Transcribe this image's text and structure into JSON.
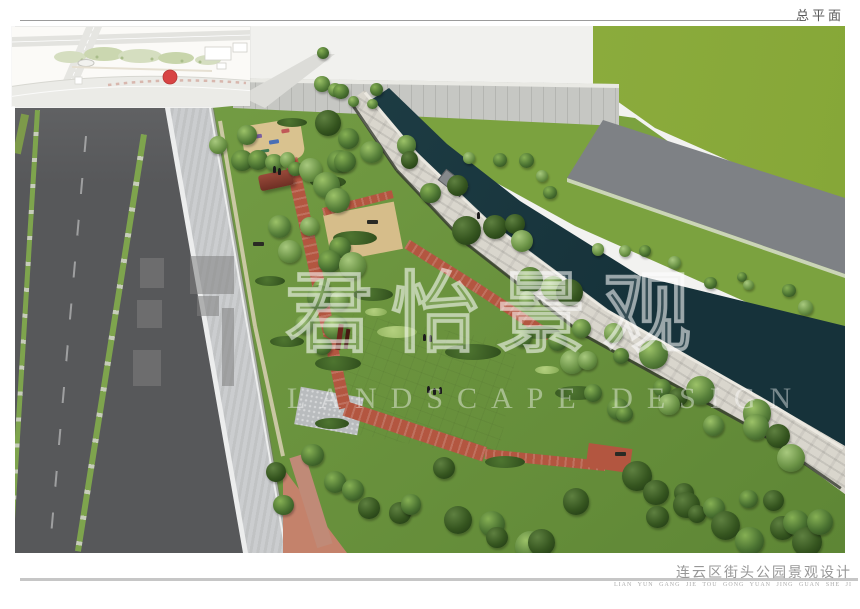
{
  "sheet": {
    "label": "总平面"
  },
  "title_block": {
    "project_title": "连云区街头公园景观设计",
    "project_title_pinyin": "LIAN YUN GANG JIE TOU GONG YUAN JING GUAN SHE JI"
  },
  "watermark": {
    "chinese_text": "君怡景观",
    "english_text": "LANDSCAPE DESIGN"
  },
  "palette": {
    "road": "#57585a",
    "sidewalk": "#cbcdcf",
    "park_green": "#6e9140",
    "lawn_green": "#8fae3e",
    "verge_green": "#7ba23f",
    "canal_dark": "#16323a",
    "canal_light": "#24454c",
    "plaza_tan": "#d6bd8a",
    "path_red": "#b35640",
    "stone": "#d9d6cd",
    "building_grey": "#c6c7c3",
    "far_road_grey": "#7e8185",
    "marker_red": "#d84444"
  }
}
